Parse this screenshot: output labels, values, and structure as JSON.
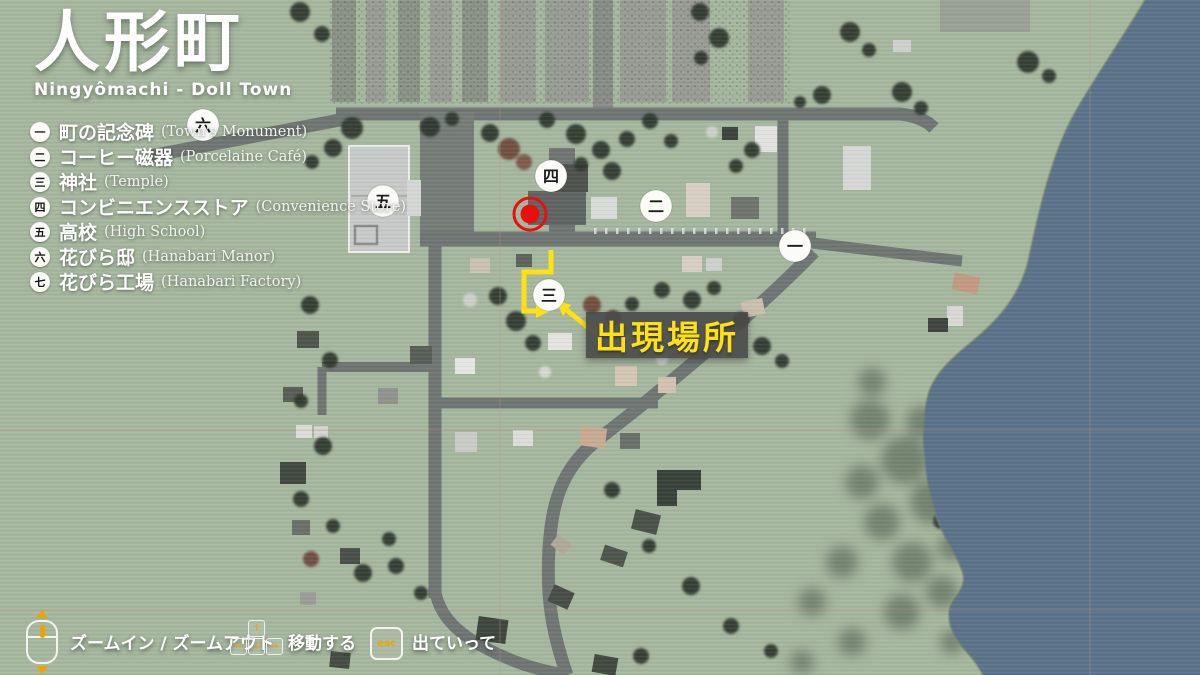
{
  "title": {
    "main": "人形町",
    "sub": "Ningyômachi - Doll Town"
  },
  "legend": {
    "items": [
      {
        "kanji": "一",
        "name_jp": "町の記念碑",
        "name_en": "(Town's Monument)"
      },
      {
        "kanji": "二",
        "name_jp": "コーヒー磁器",
        "name_en": "(Porcelaine Café)"
      },
      {
        "kanji": "三",
        "name_jp": "神社",
        "name_en": "(Temple)"
      },
      {
        "kanji": "四",
        "name_jp": "コンビニエンスストア",
        "name_en": "(Convenience Store)"
      },
      {
        "kanji": "五",
        "name_jp": "高校",
        "name_en": "(High School)"
      },
      {
        "kanji": "六",
        "name_jp": "花びら邸",
        "name_en": "(Hanabari Manor)"
      },
      {
        "kanji": "七",
        "name_jp": "花びら工場",
        "name_en": "(Hanabari Factory)"
      }
    ]
  },
  "map_markers": [
    {
      "kanji": "六",
      "location": "Hanabari Manor"
    },
    {
      "kanji": "五",
      "location": "High School"
    },
    {
      "kanji": "四",
      "location": "Convenience Store"
    },
    {
      "kanji": "二",
      "location": "Porcelaine Café"
    },
    {
      "kanji": "一",
      "location": "Town's Monument"
    },
    {
      "kanji": "三",
      "location": "Temple"
    }
  ],
  "annotations": {
    "spawn_label": "出現場所"
  },
  "controls": {
    "zoom": {
      "label": "ズームイン / ズームアウト"
    },
    "move": {
      "label": "移動する"
    },
    "exit": {
      "label": "出ていって",
      "key": "esc"
    }
  },
  "colors": {
    "highlight_yellow": "#ffe012",
    "accent_orange": "#f0a202",
    "spawn_red": "#e80f0f",
    "water_blue": "#5c7389",
    "land_green": "#a6b79f",
    "road_gray": "#6f7673"
  }
}
